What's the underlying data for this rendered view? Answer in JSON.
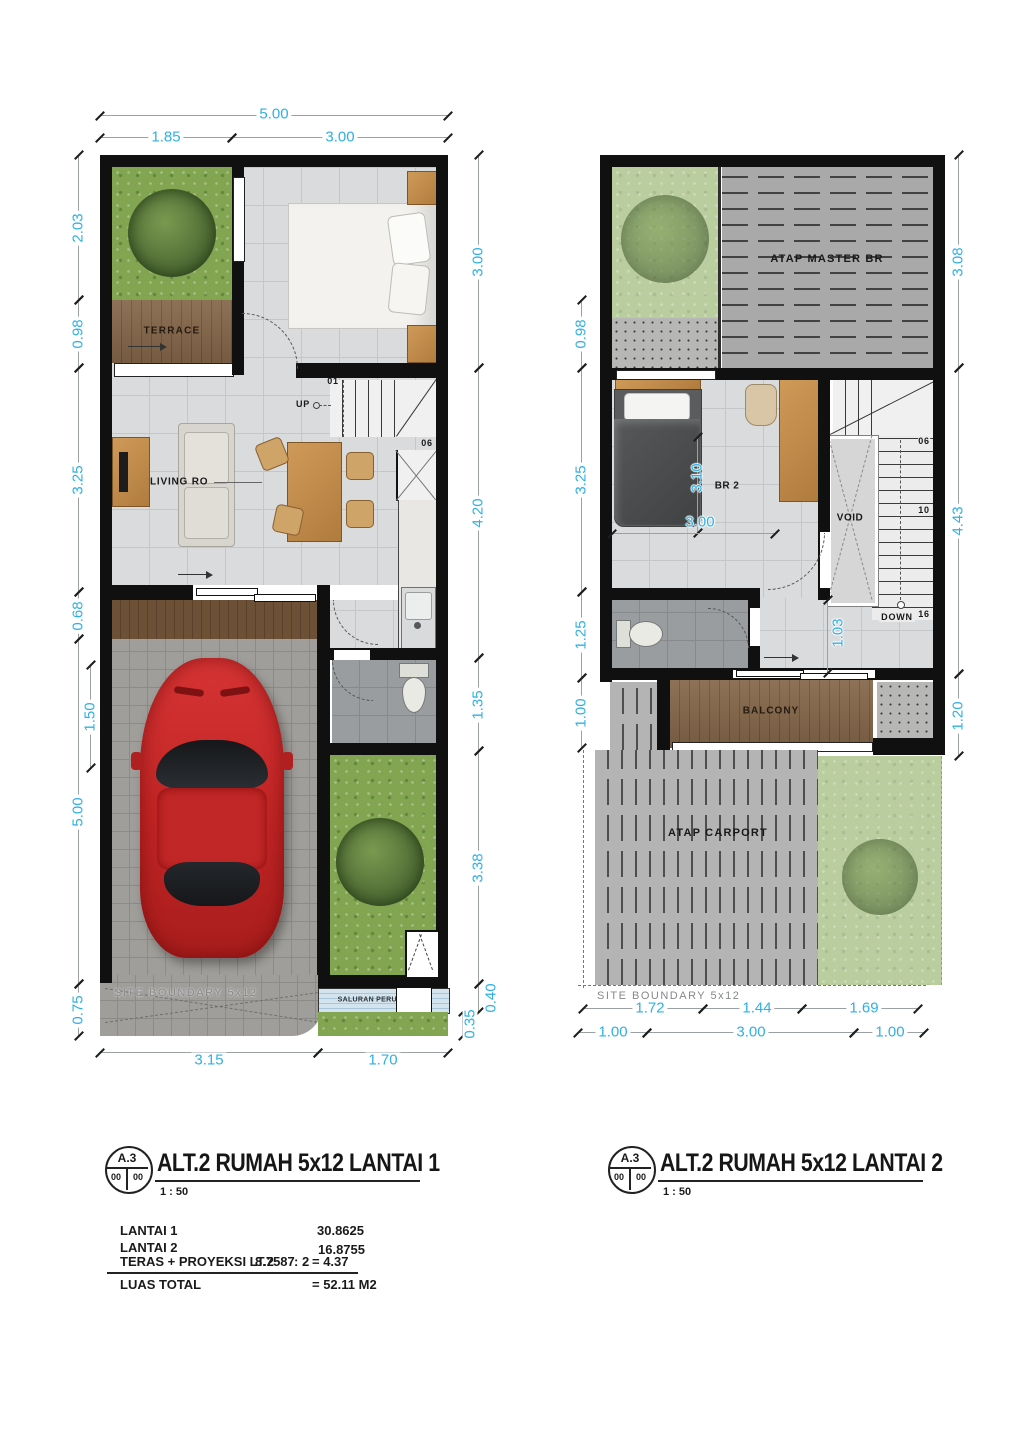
{
  "accent": "#2fb0e4",
  "lp": {
    "dims": {
      "top_total": "5.00",
      "top": [
        "1.85",
        "3.00"
      ],
      "left": [
        "2.03",
        "0.98",
        "3.25",
        "0.68",
        "5.00",
        "0.75"
      ],
      "left_inner": "1.50",
      "right": [
        "3.00",
        "4.20",
        "1.35",
        "3.38",
        "0.40",
        "0.35"
      ],
      "bottom": [
        "3.15",
        "1.70"
      ]
    },
    "labels": {
      "terrace": "TERRACE",
      "living": "LIVING RO",
      "up": "UP",
      "step_first": "01",
      "step_last": "06",
      "boundary": "SITE BOUNDARY 5x12",
      "drain": "SALURAN PERUMAHAN"
    }
  },
  "rp": {
    "dims": {
      "left": [
        "0.98",
        "3.25",
        "1.25",
        "1.00"
      ],
      "right": [
        "3.08",
        "4.43",
        "1.20"
      ],
      "bottom_row1": [
        "1.72",
        "1.44",
        "1.69"
      ],
      "bottom_row2": [
        "1.00",
        "3.00",
        "1.00"
      ],
      "inner_br2_v": "3.10",
      "inner_br2_h": "3.00",
      "inner_hall": "1.03"
    },
    "labels": {
      "atap_master": "ATAP MASTER BR",
      "br2": "BR 2",
      "void": "VOID",
      "down": "DOWN",
      "step06": "06",
      "step10": "10",
      "step16": "16",
      "balcony": "BALCONY",
      "atap_carport": "ATAP CARPORT",
      "boundary": "SITE BOUNDARY 5x12"
    }
  },
  "title_left": {
    "code": "A.3",
    "cell1": "00",
    "cell2": "00",
    "text": "ALT.2 RUMAH 5x12 LANTAI 1",
    "scale": "1 : 50"
  },
  "title_right": {
    "code": "A.3",
    "cell1": "00",
    "cell2": "00",
    "text": "ALT.2 RUMAH 5x12 LANTAI 2",
    "scale": "1 : 50"
  },
  "area_table": {
    "rows": [
      {
        "label": "LANTAI 1",
        "value": "30.8625"
      },
      {
        "label": "LANTAI 2",
        "value": "16.8755"
      },
      {
        "label": "TERAS + PROYEKSI LT.2",
        "calc": "8.7587",
        "divisor": ": 2",
        "value": "= 4.37"
      }
    ],
    "total_label": "LUAS TOTAL",
    "total_value": "= 52.11 M2"
  }
}
